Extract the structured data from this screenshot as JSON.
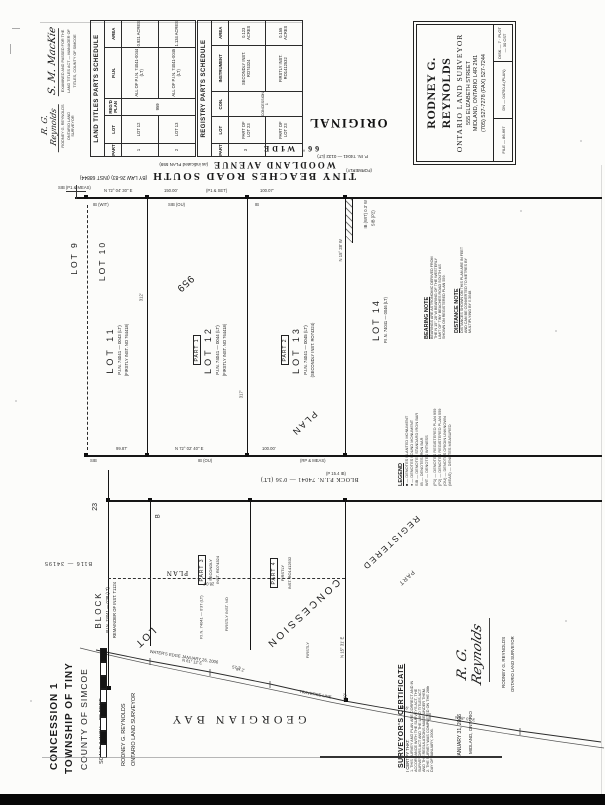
{
  "stamps": {
    "original": "ORIGINAL",
    "registered": "REGISTERED",
    "part": "PART",
    "deposit": "B116 — 34195"
  },
  "approvals": {
    "examiner": {
      "signature": "S. M. MacKie",
      "line1": "EXAMINED AND PASSED FOR THE",
      "line2": "LAND TITLES ACT — MANAGER OF",
      "line3": "TITLES, COUNTY OF SIMCOE"
    },
    "surveyor": {
      "signature": "R. G. Reynolds",
      "line1": "RODNEY G. REYNOLDS",
      "line2": "ONTARIO LAND SURVEYOR"
    }
  },
  "land_titles": {
    "title": "LAND TITLES PARTS SCHEDULE",
    "h_part": "PART",
    "h_lot": "LOT",
    "h_plan": "REG'D PLAN",
    "h_pin": "P.I.N.",
    "h_area": "AREA",
    "plan": "959",
    "rows": [
      {
        "part": "1",
        "lot": "LOT 12",
        "pin": "ALL OF P.I.N. 74041-0044 (LT)",
        "area": "0.921 ACRES"
      },
      {
        "part": "2",
        "lot": "LOT 13",
        "pin": "ALL OF P.I.N. 74041-0045 (LT)",
        "area": "1.134 ACRES"
      }
    ]
  },
  "registry": {
    "title": "REGISTRY PARTS SCHEDULE",
    "h_part": "PART",
    "h_lot": "LOT",
    "h_con": "CON.",
    "h_inst": "INSTRUMENT",
    "h_area": "AREA",
    "con": "CONCESSION 1",
    "rows": [
      {
        "part": "3",
        "lot": "PART OF LOT 23",
        "inst": "SECONDLY INST. RO74324",
        "area": "0.123 ACRES"
      },
      {
        "part": "4",
        "lot": "PART OF LOT 23",
        "inst": "FIRSTLY INST. RO1412532",
        "area": "0.155 ACRES"
      }
    ]
  },
  "firm": {
    "name": "RODNEY G. REYNOLDS",
    "title": "ONTARIO LAND SURVEYOR",
    "address": "555 ELIZABETH STREET",
    "city": "MIDLAND, ONTARIO   L4R 2M1",
    "phone": "(705) 527-7278   (FAX) 527-7244",
    "file": "FILE — 86-667",
    "dn": "DN — 04750-A (PLAN)",
    "plot": "DISK — 7 · PLOT — 30 CST"
  },
  "roads": {
    "main": "TINY  BEACHES  ROAD  SOUTH",
    "main_note": "(BY LAW 26-83)  (INST 68844)",
    "secondary": "WOODLAND    AVENUE",
    "secondary_note": "(as indicated PLAN 559)",
    "width": "66'  WIDE",
    "pin": "P. IN. 74041 — 0132 (LT)",
    "formerly": "(FORMERLY)"
  },
  "township": {
    "lot9": "LOT  9",
    "lot10": "LOT  10"
  },
  "parcels": {
    "lot11": {
      "name": "LOT   11",
      "pin": "P.I.N. 74041 — 0043 (LT)",
      "inst": "(FIRSTLY INST. NO 764418)"
    },
    "lot12": {
      "part": "PART 1",
      "name": "LOT   12",
      "pin": "P.I.N. 74041 — 0044 (LT)",
      "inst": "(FIRSTLY INST. NO 764418)"
    },
    "lot13": {
      "part": "PART 2",
      "name": "LOT   13",
      "pin": "P.I.N. 74041 — 0045 (LT)",
      "inst": "(SECONDLY INST. RO74324)"
    },
    "lot14": {
      "name": "LOT  14",
      "pin": "P.I.N. 74041 — 0046 (LT)"
    },
    "plan959": "959",
    "plan_diag": "PLAN"
  },
  "notes": {
    "bearing": {
      "title": "BEARING NOTE",
      "lines": [
        "BEARINGS ARE ASTRONOMIC DERIVED FROM",
        "THE N 15° 28' W BEARING OF THE WESTERLY",
        "LIMIT OF TINY BEACHES ROAD SOUTH AS",
        "SHOWN ON REGISTERED PLAN 559."
      ]
    },
    "distance": {
      "title": "DISTANCE NOTE",
      "lines": [
        "DISTANCES SHOWN ON THIS PLAN ARE IN FEET",
        "AND CAN BE CONVERTED TO METRES BY",
        "MULTIPLYING BY 0.3048."
      ]
    },
    "legend": {
      "title": "LEGEND",
      "lines": [
        "■ — DENOTES PLANTED MONUMENT",
        "● — DENOTES FOUND MONUMENT",
        "SIB — DENOTES STANDARD IRON BAR",
        "IB — DENOTES IRON BAR",
        "WIT — DENOTES WITNESS",
        "(P1) — DENOTES REGISTERED PLAN 959",
        "(P2) — DENOTES REGISTERED PLAN 559",
        "(OU) — DENOTES ORIGIN UNKNOWN",
        "(MEAS) — DENOTES MEASURED"
      ]
    }
  },
  "band": {
    "text": "BLOCK      P.I.N. 74041 — 0'36 (LT)"
  },
  "lower": {
    "block": {
      "name": "BLOCK",
      "pin": "P.I.N. 74041 — 0'38 (LT)",
      "note": "REMAINDER OF INST. T1124",
      "num": "23",
      "b": "B"
    },
    "part3": {
      "part": "PART 3",
      "l1": "SECONDLY",
      "l2": "INST. RO74324"
    },
    "part4": {
      "part": "PART 4",
      "l1": "FIRSTLY",
      "l2": "INST. RO1412532"
    },
    "plan": "PLAN",
    "pin1": "P.I.N. 74041 — 0'37 (LT)",
    "pin2": "FIRSTLY INST. NO",
    "firstly": "FIRSTLY",
    "concession": "CONCESSION",
    "lot": "LOT",
    "bearing": "N 15° 31' E",
    "d419": "419'"
  },
  "shore": {
    "bay": "GEORGIAN    BAY",
    "edge": "WATER'S EDGE  JANUARY 26, 2006",
    "traverse": "TRAVERSE  LINE",
    "d1": "67.2'",
    "d2": "N 61° 12' E",
    "d3": "93.6'",
    "d4": "N 68° 07' E"
  },
  "titleblock": {
    "l1": "CONCESSION 1",
    "l2": "TOWNSHIP  OF  TINY",
    "l3": "COUNTY  OF  SIMCOE",
    "scale": "SCALE    1 INCH  =  30 FEET",
    "firm1": "RODNEY G. REYNOLDS",
    "firm2": "ONTARIO LAND SURVEYOR"
  },
  "certificate": {
    "title": "SURVEYOR'S CERTIFICATE",
    "intro": "I CERTIFY THAT:",
    "lines": [
      "1. THIS SURVEY AND PLAN ARE CORRECT AND IN",
      "ACCORDANCE WITH THE SURVEYS ACT, THE",
      "SURVEYORS ACT AND THE LAND TITLES ACT",
      "AND THE REGULATIONS MADE UNDER THEM.",
      "2. THE SURVEY WAS COMPLETED ON THE 26th",
      "DAY OF JANUARY, 2006."
    ],
    "date": "JANUARY 31, 2006",
    "place": "MIDLAND, ONTARIO",
    "signature": "R. G. Reynolds",
    "sig_name": "RODNEY G. REYNOLDS",
    "sig_title": "ONTARIO LAND SURVEYOR"
  },
  "annotations": [
    "SIB (P1 & MEAS)",
    "N 72° 04' 30\" E",
    "150.00'",
    "(P1 & SET)",
    "100.07'",
    "IB (WIT)",
    "SIB (OU)",
    "IB",
    "312'",
    "317'",
    "N 15° 28' W",
    "IB (WIT) 0.3' W",
    "SIB (P2)",
    "99.87'",
    "N 72° 02' 40\" E",
    "100.00'",
    "SIB",
    "IB (OU)",
    "28.04'",
    "(P 15.4 IB)",
    "57.2'",
    "(RP & MEAS)"
  ]
}
